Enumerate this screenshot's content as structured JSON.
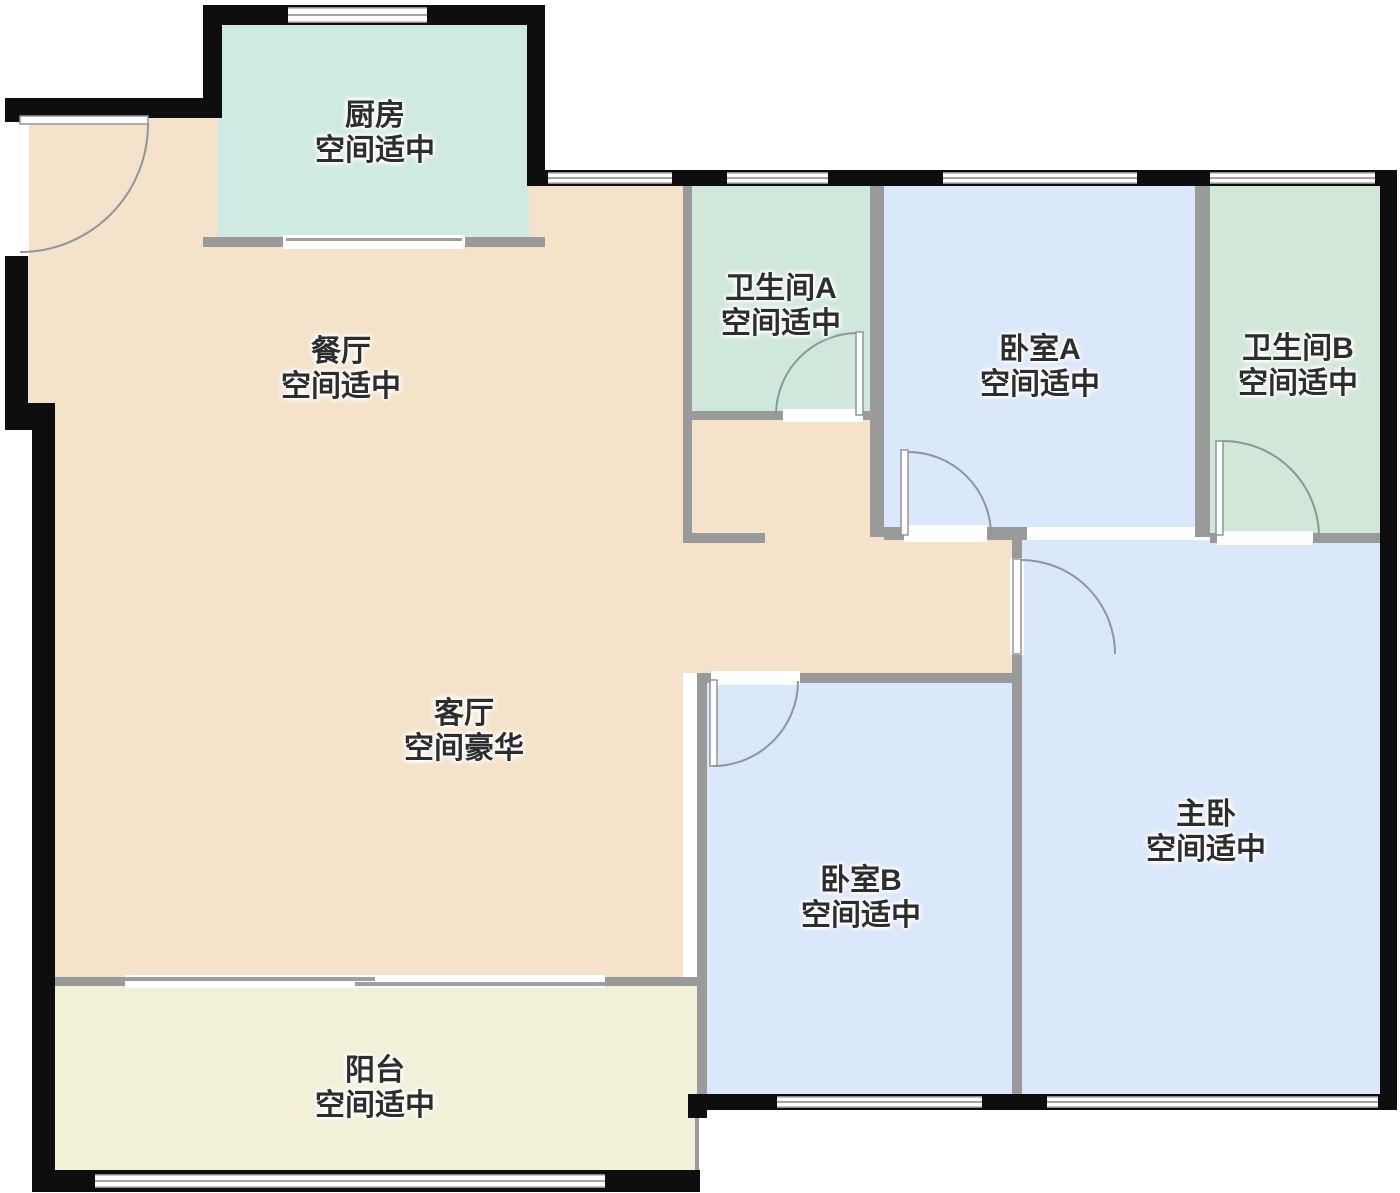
{
  "floorplan": {
    "type": "apartment-floor-plan",
    "rooms": {
      "kitchen": {
        "name": "厨房",
        "size": "空间适中",
        "color": "#cfe9e3"
      },
      "dining": {
        "name": "餐厅",
        "size": "空间适中",
        "color": "#f4e3ca"
      },
      "bathroom_a": {
        "name": "卫生间A",
        "size": "空间适中",
        "color": "#cfe8db"
      },
      "bedroom_a": {
        "name": "卧室A",
        "size": "空间适中",
        "color": "#dbe7fa"
      },
      "bathroom_b": {
        "name": "卫生间B",
        "size": "空间适中",
        "color": "#d1e7d8"
      },
      "living": {
        "name": "客厅",
        "size": "空间豪华",
        "color": "#f4e3ca"
      },
      "corridor": {
        "name": "",
        "size": "",
        "color": "#f4e3ca"
      },
      "bedroom_b": {
        "name": "卧室B",
        "size": "空间适中",
        "color": "#dbe7fa"
      },
      "master": {
        "name": "主卧",
        "size": "空间适中",
        "color": "#dbe7fa"
      },
      "balcony": {
        "name": "阳台",
        "size": "空间适中",
        "color": "#f2f0d7"
      }
    },
    "colors": {
      "outer_wall": "#0e0e0e",
      "inner_wall": "#9a9a9a",
      "door_line": "#8f959b",
      "background": "#ffffff",
      "label_text": "#2d2d2d"
    }
  }
}
